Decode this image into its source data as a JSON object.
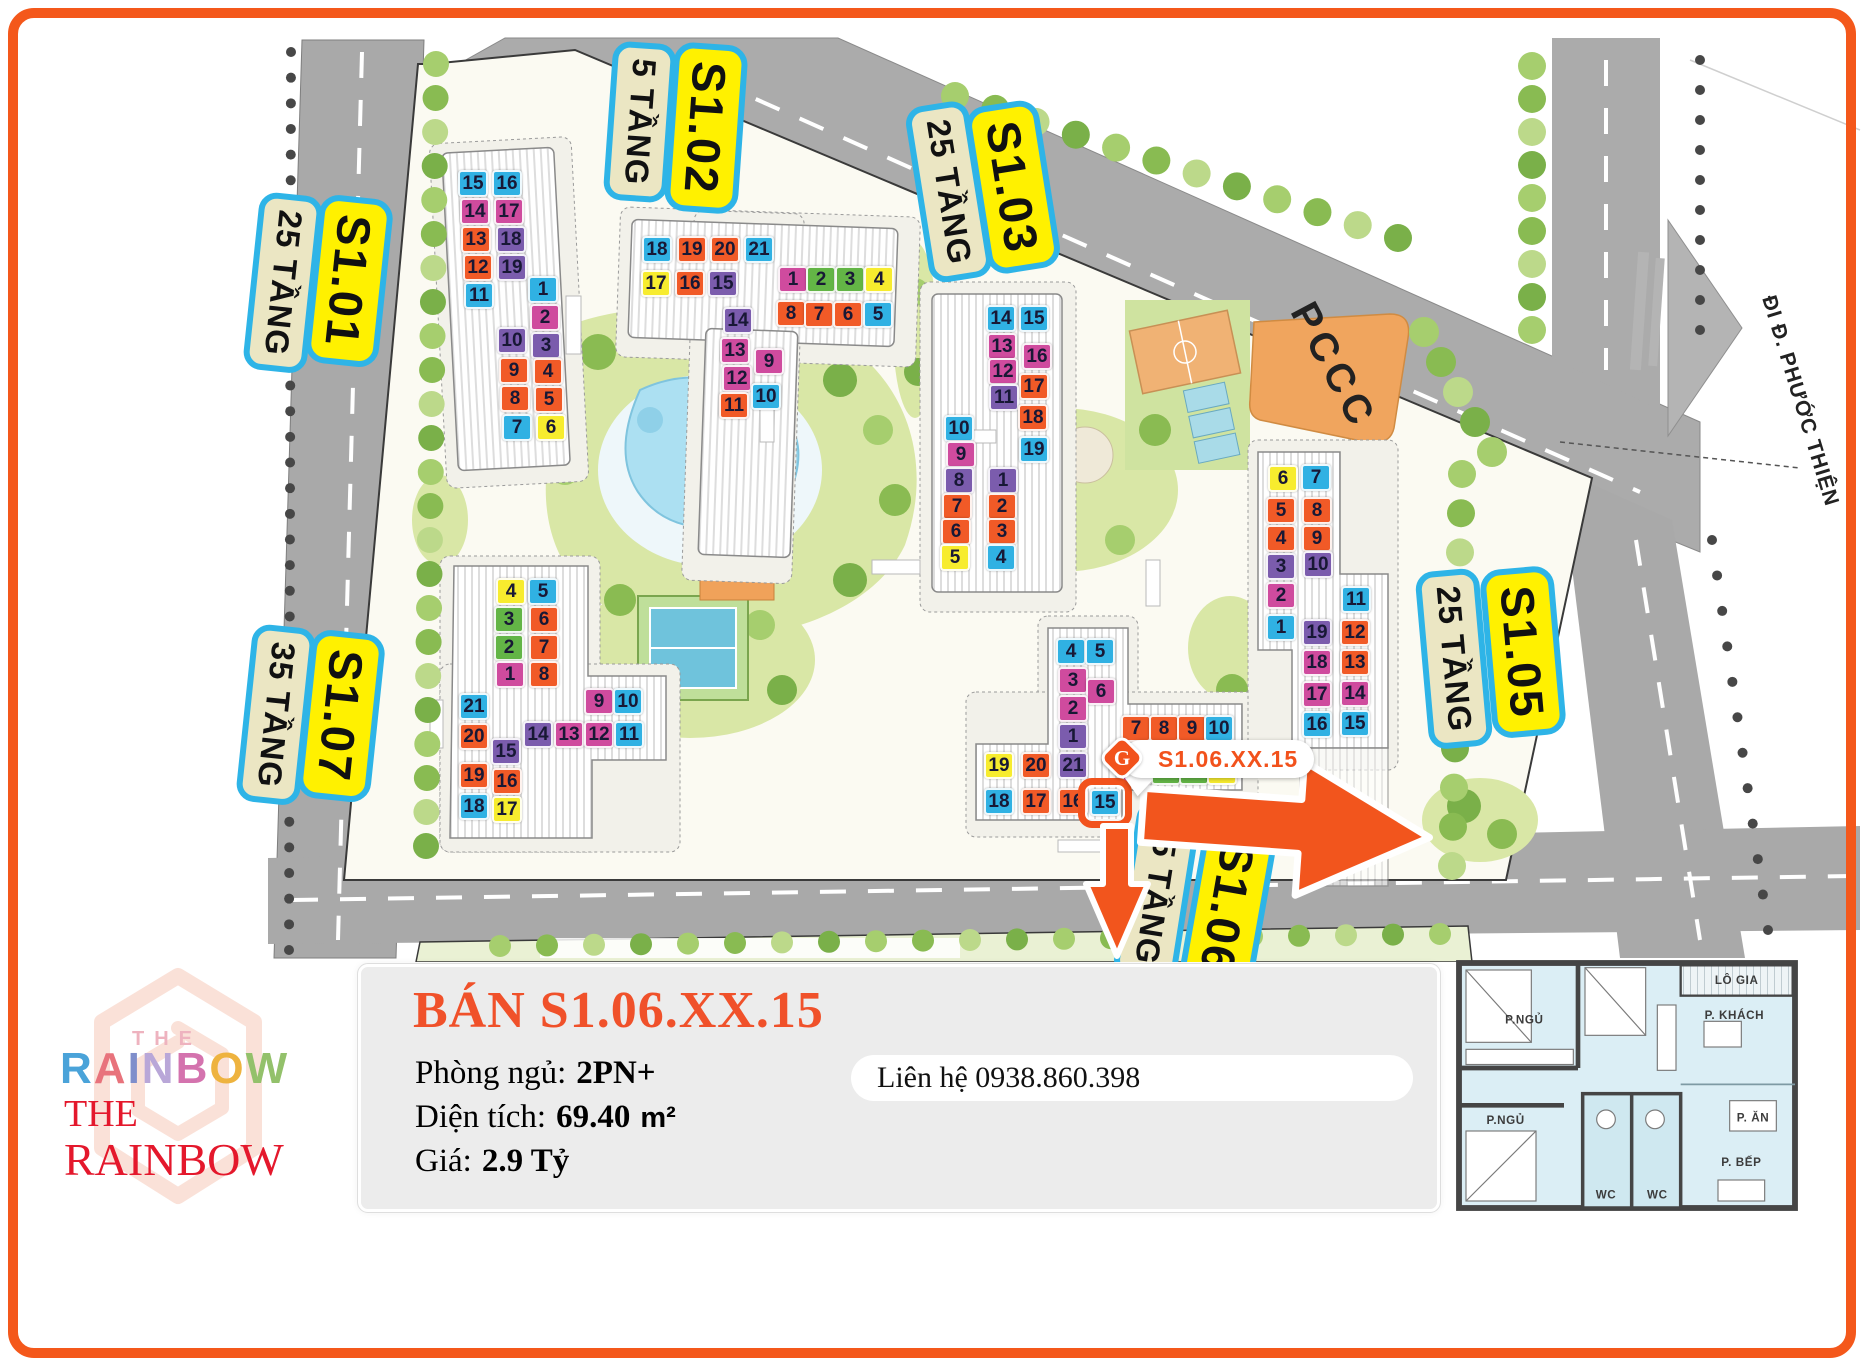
{
  "colors": {
    "b": "#30b1e3",
    "m": "#cf4b9e",
    "o": "#f15a27",
    "p": "#7b5cad",
    "y": "#f7ec2e",
    "g": "#63b546",
    "accent": "#f2521c",
    "label_yellow": "#fff100",
    "label_cream": "#ebe6c3",
    "label_border": "#2eb4e7",
    "title_red": "#f0512a",
    "logo_red": "#e4182c",
    "road": "#a9a9a9",
    "pccc_fill": "#f0a55e"
  },
  "map": {
    "road_sign": "ĐI Đ. PHƯỚC THIỆN",
    "pccc_label": "PCCC",
    "callout": {
      "text": "S1.06.XX.15",
      "icon": "rainbow-diamond-logo"
    },
    "highlight": {
      "building": "S1.06",
      "unit": 15
    },
    "tower_labels": [
      {
        "id": "s101-floors",
        "text": "25 TẦNG",
        "kind": "floors",
        "x": 283,
        "y": 283,
        "rot": 96
      },
      {
        "id": "s101-name",
        "text": "S1.01",
        "kind": "name",
        "x": 349,
        "y": 281,
        "rot": 96
      },
      {
        "id": "s102-floors",
        "text": "5 TẦNG",
        "kind": "floors",
        "x": 640,
        "y": 122,
        "rot": 94
      },
      {
        "id": "s102-name",
        "text": "S1.02",
        "kind": "name",
        "x": 706,
        "y": 128,
        "rot": 94
      },
      {
        "id": "s103-floors",
        "text": "25 TẦNG",
        "kind": "floors",
        "x": 949,
        "y": 192,
        "rot": 81
      },
      {
        "id": "s103-name",
        "text": "S1.03",
        "kind": "name",
        "x": 1013,
        "y": 187,
        "rot": 81
      },
      {
        "id": "s107-floors",
        "text": "35 TẦNG",
        "kind": "floors",
        "x": 276,
        "y": 715,
        "rot": 96
      },
      {
        "id": "s107-name",
        "text": "S1.07",
        "kind": "name",
        "x": 341,
        "y": 716,
        "rot": 96
      },
      {
        "id": "s105-floors",
        "text": "25 TẦNG",
        "kind": "floors",
        "x": 1454,
        "y": 659,
        "rot": 85
      },
      {
        "id": "s105-name",
        "text": "S1.05",
        "kind": "name",
        "x": 1523,
        "y": 652,
        "rot": 85
      },
      {
        "id": "s106-floors",
        "text": "35 TẦNG",
        "kind": "floors",
        "x": 1157,
        "y": 892,
        "rot": 99
      },
      {
        "id": "s106-name",
        "text": "S1.06",
        "kind": "name",
        "x": 1228,
        "y": 908,
        "rot": 100
      }
    ],
    "buildings": [
      {
        "id": "S1.01",
        "cells": [
          {
            "n": 15,
            "c": "b",
            "x": 458,
            "y": 170
          },
          {
            "n": 16,
            "c": "b",
            "x": 492,
            "y": 170
          },
          {
            "n": 14,
            "c": "m",
            "x": 460,
            "y": 198
          },
          {
            "n": 17,
            "c": "m",
            "x": 494,
            "y": 198
          },
          {
            "n": 13,
            "c": "o",
            "x": 461,
            "y": 226
          },
          {
            "n": 18,
            "c": "p",
            "x": 496,
            "y": 226
          },
          {
            "n": 12,
            "c": "o",
            "x": 463,
            "y": 254
          },
          {
            "n": 19,
            "c": "p",
            "x": 497,
            "y": 254
          },
          {
            "n": 11,
            "c": "b",
            "x": 464,
            "y": 282
          },
          {
            "n": 1,
            "c": "b",
            "x": 528,
            "y": 276
          },
          {
            "n": 2,
            "c": "m",
            "x": 530,
            "y": 304
          },
          {
            "n": 3,
            "c": "p",
            "x": 531,
            "y": 332
          },
          {
            "n": 10,
            "c": "p",
            "x": 497,
            "y": 327
          },
          {
            "n": 9,
            "c": "o",
            "x": 499,
            "y": 357
          },
          {
            "n": 4,
            "c": "o",
            "x": 533,
            "y": 358
          },
          {
            "n": 8,
            "c": "o",
            "x": 500,
            "y": 385
          },
          {
            "n": 5,
            "c": "o",
            "x": 534,
            "y": 386
          },
          {
            "n": 7,
            "c": "b",
            "x": 502,
            "y": 414
          },
          {
            "n": 6,
            "c": "y",
            "x": 536,
            "y": 414
          }
        ]
      },
      {
        "id": "S1.02",
        "cells": [
          {
            "n": 18,
            "c": "b",
            "x": 642,
            "y": 236
          },
          {
            "n": 19,
            "c": "o",
            "x": 677,
            "y": 236
          },
          {
            "n": 20,
            "c": "o",
            "x": 710,
            "y": 236
          },
          {
            "n": 21,
            "c": "b",
            "x": 744,
            "y": 236
          },
          {
            "n": 17,
            "c": "y",
            "x": 641,
            "y": 270
          },
          {
            "n": 16,
            "c": "o",
            "x": 675,
            "y": 270
          },
          {
            "n": 15,
            "c": "p",
            "x": 708,
            "y": 270
          },
          {
            "n": 14,
            "c": "p",
            "x": 723,
            "y": 307
          },
          {
            "n": 13,
            "c": "m",
            "x": 720,
            "y": 337
          },
          {
            "n": 12,
            "c": "m",
            "x": 722,
            "y": 365
          },
          {
            "n": 9,
            "c": "m",
            "x": 754,
            "y": 348
          },
          {
            "n": 11,
            "c": "o",
            "x": 719,
            "y": 392
          },
          {
            "n": 10,
            "c": "b",
            "x": 751,
            "y": 383
          },
          {
            "n": 1,
            "c": "m",
            "x": 778,
            "y": 266
          },
          {
            "n": 2,
            "c": "g",
            "x": 806,
            "y": 266
          },
          {
            "n": 3,
            "c": "g",
            "x": 835,
            "y": 266
          },
          {
            "n": 4,
            "c": "y",
            "x": 864,
            "y": 266
          },
          {
            "n": 8,
            "c": "o",
            "x": 776,
            "y": 300
          },
          {
            "n": 7,
            "c": "o",
            "x": 804,
            "y": 301
          },
          {
            "n": 6,
            "c": "o",
            "x": 833,
            "y": 301
          },
          {
            "n": 5,
            "c": "b",
            "x": 863,
            "y": 301
          }
        ]
      },
      {
        "id": "S1.03",
        "cells": [
          {
            "n": 14,
            "c": "b",
            "x": 986,
            "y": 305
          },
          {
            "n": 15,
            "c": "b",
            "x": 1019,
            "y": 305
          },
          {
            "n": 13,
            "c": "m",
            "x": 987,
            "y": 333
          },
          {
            "n": 16,
            "c": "m",
            "x": 1022,
            "y": 343
          },
          {
            "n": 12,
            "c": "m",
            "x": 988,
            "y": 358
          },
          {
            "n": 17,
            "c": "o",
            "x": 1019,
            "y": 373
          },
          {
            "n": 11,
            "c": "p",
            "x": 989,
            "y": 384
          },
          {
            "n": 18,
            "c": "o",
            "x": 1018,
            "y": 404
          },
          {
            "n": 19,
            "c": "b",
            "x": 1019,
            "y": 436
          },
          {
            "n": 10,
            "c": "b",
            "x": 944,
            "y": 415
          },
          {
            "n": 9,
            "c": "m",
            "x": 946,
            "y": 441
          },
          {
            "n": 8,
            "c": "p",
            "x": 944,
            "y": 467
          },
          {
            "n": 1,
            "c": "p",
            "x": 988,
            "y": 467
          },
          {
            "n": 7,
            "c": "o",
            "x": 942,
            "y": 493
          },
          {
            "n": 2,
            "c": "o",
            "x": 987,
            "y": 493
          },
          {
            "n": 6,
            "c": "o",
            "x": 941,
            "y": 518
          },
          {
            "n": 3,
            "c": "o",
            "x": 987,
            "y": 518
          },
          {
            "n": 5,
            "c": "y",
            "x": 940,
            "y": 544
          },
          {
            "n": 4,
            "c": "b",
            "x": 986,
            "y": 544
          }
        ]
      },
      {
        "id": "S1.07",
        "cells": [
          {
            "n": 4,
            "c": "y",
            "x": 496,
            "y": 578
          },
          {
            "n": 5,
            "c": "b",
            "x": 528,
            "y": 578
          },
          {
            "n": 3,
            "c": "g",
            "x": 494,
            "y": 606
          },
          {
            "n": 6,
            "c": "o",
            "x": 529,
            "y": 606
          },
          {
            "n": 2,
            "c": "g",
            "x": 494,
            "y": 634
          },
          {
            "n": 7,
            "c": "o",
            "x": 529,
            "y": 634
          },
          {
            "n": 1,
            "c": "m",
            "x": 495,
            "y": 661
          },
          {
            "n": 8,
            "c": "o",
            "x": 529,
            "y": 661
          },
          {
            "n": 21,
            "c": "b",
            "x": 459,
            "y": 693
          },
          {
            "n": 9,
            "c": "m",
            "x": 584,
            "y": 688
          },
          {
            "n": 10,
            "c": "b",
            "x": 613,
            "y": 688
          },
          {
            "n": 20,
            "c": "o",
            "x": 459,
            "y": 723
          },
          {
            "n": 15,
            "c": "p",
            "x": 491,
            "y": 738
          },
          {
            "n": 14,
            "c": "p",
            "x": 523,
            "y": 721
          },
          {
            "n": 13,
            "c": "m",
            "x": 554,
            "y": 721
          },
          {
            "n": 12,
            "c": "m",
            "x": 584,
            "y": 721
          },
          {
            "n": 11,
            "c": "b",
            "x": 614,
            "y": 721
          },
          {
            "n": 19,
            "c": "o",
            "x": 459,
            "y": 762
          },
          {
            "n": 16,
            "c": "o",
            "x": 492,
            "y": 768
          },
          {
            "n": 18,
            "c": "b",
            "x": 459,
            "y": 793
          },
          {
            "n": 17,
            "c": "y",
            "x": 492,
            "y": 796
          }
        ]
      },
      {
        "id": "S1.06",
        "cells": [
          {
            "n": 4,
            "c": "b",
            "x": 1056,
            "y": 638
          },
          {
            "n": 5,
            "c": "b",
            "x": 1085,
            "y": 638
          },
          {
            "n": 3,
            "c": "m",
            "x": 1058,
            "y": 667
          },
          {
            "n": 6,
            "c": "m",
            "x": 1086,
            "y": 678
          },
          {
            "n": 2,
            "c": "m",
            "x": 1058,
            "y": 695
          },
          {
            "n": 1,
            "c": "p",
            "x": 1058,
            "y": 723
          },
          {
            "n": 7,
            "c": "o",
            "x": 1121,
            "y": 715
          },
          {
            "n": 8,
            "c": "o",
            "x": 1149,
            "y": 715
          },
          {
            "n": 9,
            "c": "o",
            "x": 1177,
            "y": 715
          },
          {
            "n": 10,
            "c": "b",
            "x": 1204,
            "y": 715
          },
          {
            "n": 19,
            "c": "y",
            "x": 984,
            "y": 752
          },
          {
            "n": 20,
            "c": "o",
            "x": 1021,
            "y": 752
          },
          {
            "n": 21,
            "c": "p",
            "x": 1058,
            "y": 752
          },
          {
            "n": 14,
            "c": "m",
            "x": 1122,
            "y": 758
          },
          {
            "n": 13,
            "c": "g",
            "x": 1151,
            "y": 758
          },
          {
            "n": 12,
            "c": "g",
            "x": 1179,
            "y": 758
          },
          {
            "n": 11,
            "c": "y",
            "x": 1207,
            "y": 758
          },
          {
            "n": 18,
            "c": "b",
            "x": 984,
            "y": 788
          },
          {
            "n": 17,
            "c": "o",
            "x": 1021,
            "y": 788
          },
          {
            "n": 16,
            "c": "o",
            "x": 1058,
            "y": 788
          },
          {
            "n": 15,
            "c": "b",
            "x": 1090,
            "y": 789
          }
        ]
      },
      {
        "id": "S1.05",
        "cells": [
          {
            "n": 6,
            "c": "y",
            "x": 1268,
            "y": 465
          },
          {
            "n": 7,
            "c": "b",
            "x": 1301,
            "y": 464
          },
          {
            "n": 5,
            "c": "o",
            "x": 1266,
            "y": 497
          },
          {
            "n": 8,
            "c": "o",
            "x": 1302,
            "y": 497
          },
          {
            "n": 4,
            "c": "o",
            "x": 1266,
            "y": 525
          },
          {
            "n": 9,
            "c": "o",
            "x": 1302,
            "y": 525
          },
          {
            "n": 3,
            "c": "p",
            "x": 1266,
            "y": 553
          },
          {
            "n": 10,
            "c": "p",
            "x": 1303,
            "y": 551
          },
          {
            "n": 2,
            "c": "m",
            "x": 1266,
            "y": 582
          },
          {
            "n": 11,
            "c": "b",
            "x": 1341,
            "y": 586
          },
          {
            "n": 1,
            "c": "b",
            "x": 1266,
            "y": 614
          },
          {
            "n": 19,
            "c": "p",
            "x": 1302,
            "y": 619
          },
          {
            "n": 12,
            "c": "o",
            "x": 1340,
            "y": 619
          },
          {
            "n": 18,
            "c": "m",
            "x": 1302,
            "y": 649
          },
          {
            "n": 13,
            "c": "o",
            "x": 1340,
            "y": 649
          },
          {
            "n": 17,
            "c": "m",
            "x": 1302,
            "y": 681
          },
          {
            "n": 14,
            "c": "m",
            "x": 1340,
            "y": 680
          },
          {
            "n": 16,
            "c": "b",
            "x": 1302,
            "y": 711
          },
          {
            "n": 15,
            "c": "b",
            "x": 1340,
            "y": 710
          }
        ]
      }
    ]
  },
  "panel": {
    "title": "BÁN S1.06.XX.15",
    "rows": [
      {
        "label": "Phòng ngủ:",
        "value": "2PN+"
      },
      {
        "label": "Diện tích:",
        "value": "69.40",
        "unit": "m²"
      },
      {
        "label": "Giá:",
        "value": "2.9 Tỷ"
      }
    ],
    "contact": "Liên hệ 0938.860.398"
  },
  "logo": {
    "the_small": "THE",
    "rainbow_letters": [
      {
        "ch": "R",
        "color": "#4aa3d9"
      },
      {
        "ch": "A",
        "color": "#e8737c"
      },
      {
        "ch": "I",
        "color": "#7f8ecb"
      },
      {
        "ch": "N",
        "color": "#b9a7d8"
      },
      {
        "ch": "B",
        "color": "#d473ae"
      },
      {
        "ch": "O",
        "color": "#eeb33f"
      },
      {
        "ch": "W",
        "color": "#93c16b"
      }
    ],
    "the_serif": "THE",
    "rainbow_serif": "RAINBOW"
  },
  "floorplan": {
    "rooms": [
      "P.NGỦ",
      "LÔ GIA",
      "P. KHÁCH",
      "P.NGỦ",
      "P. ĂN",
      "P. BẾP",
      "WC",
      "WC"
    ]
  }
}
